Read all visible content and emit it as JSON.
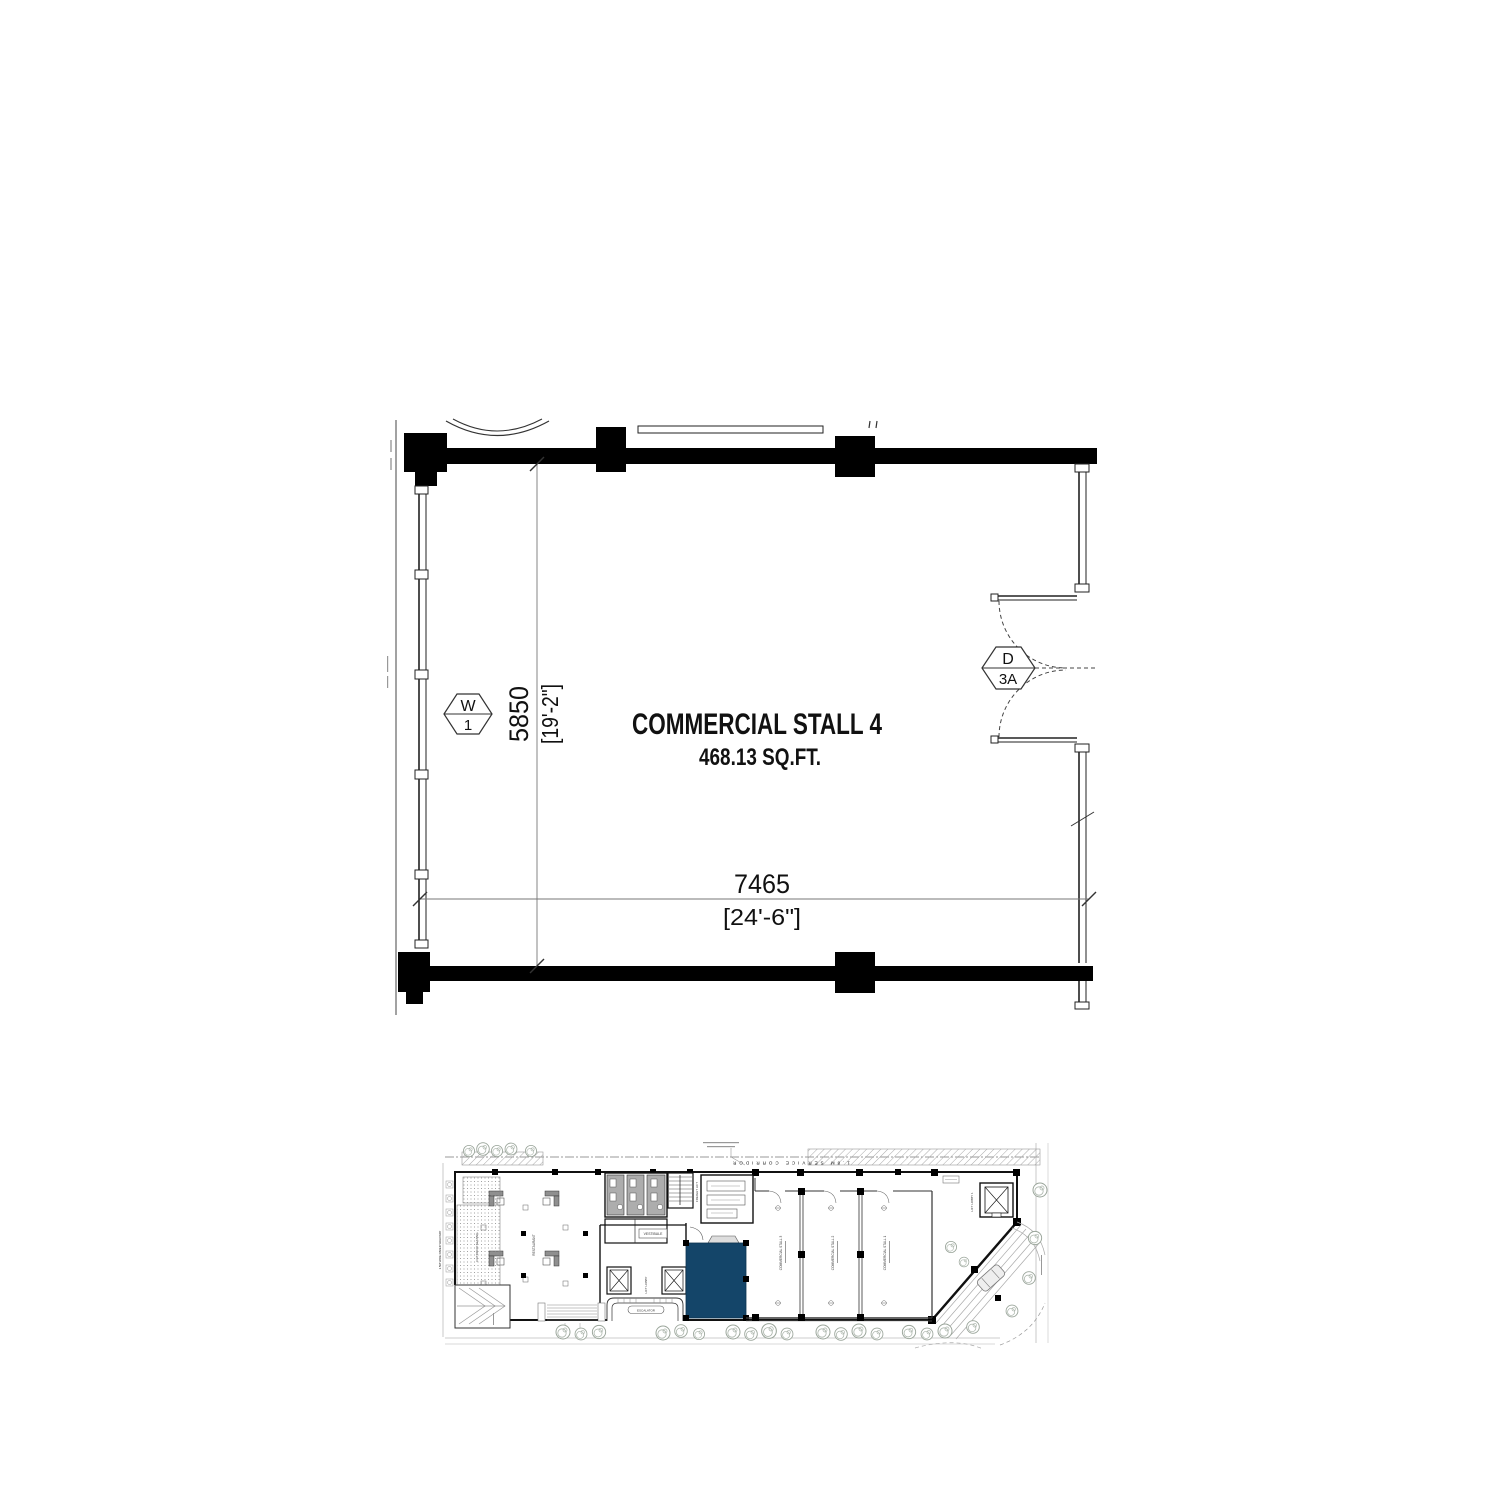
{
  "colors": {
    "highlight": "#144569",
    "wall": "#000000",
    "thin_line": "#555555"
  },
  "main_plan": {
    "title": "COMMERCIAL STALL 4",
    "area": "468.13 SQ.FT.",
    "dim_width": {
      "mm": "7465",
      "imperial": "[24'-6\"]"
    },
    "dim_height": {
      "mm": "5850",
      "imperial": "[19'-2\"]"
    },
    "window_tag": {
      "letter": "W",
      "number": "1"
    },
    "door_tag": {
      "letter": "D",
      "number": "3A"
    }
  },
  "key_plan": {
    "corridor_label": "1.8M SERVICE CORRIDOR",
    "stall_labels": [
      "COMMERCIAL STALL 3",
      "COMMERCIAL STALL 2",
      "COMMERCIAL STALL 1"
    ],
    "lift_lobby_label": "LIFT LOBBY",
    "lift_lobby1_label": "LIFT LOBBY 1",
    "freight_lift_label": "FREIGHT LIFT",
    "vestibule_label": "VESTIBULE",
    "escalator_label": "ESCALATOR",
    "restaurant_label": "RESTAURANT",
    "terrace_label": "OUTDOOR SEATING",
    "walkway_label": "1.5M WIDE PAVED WALKWAY"
  }
}
